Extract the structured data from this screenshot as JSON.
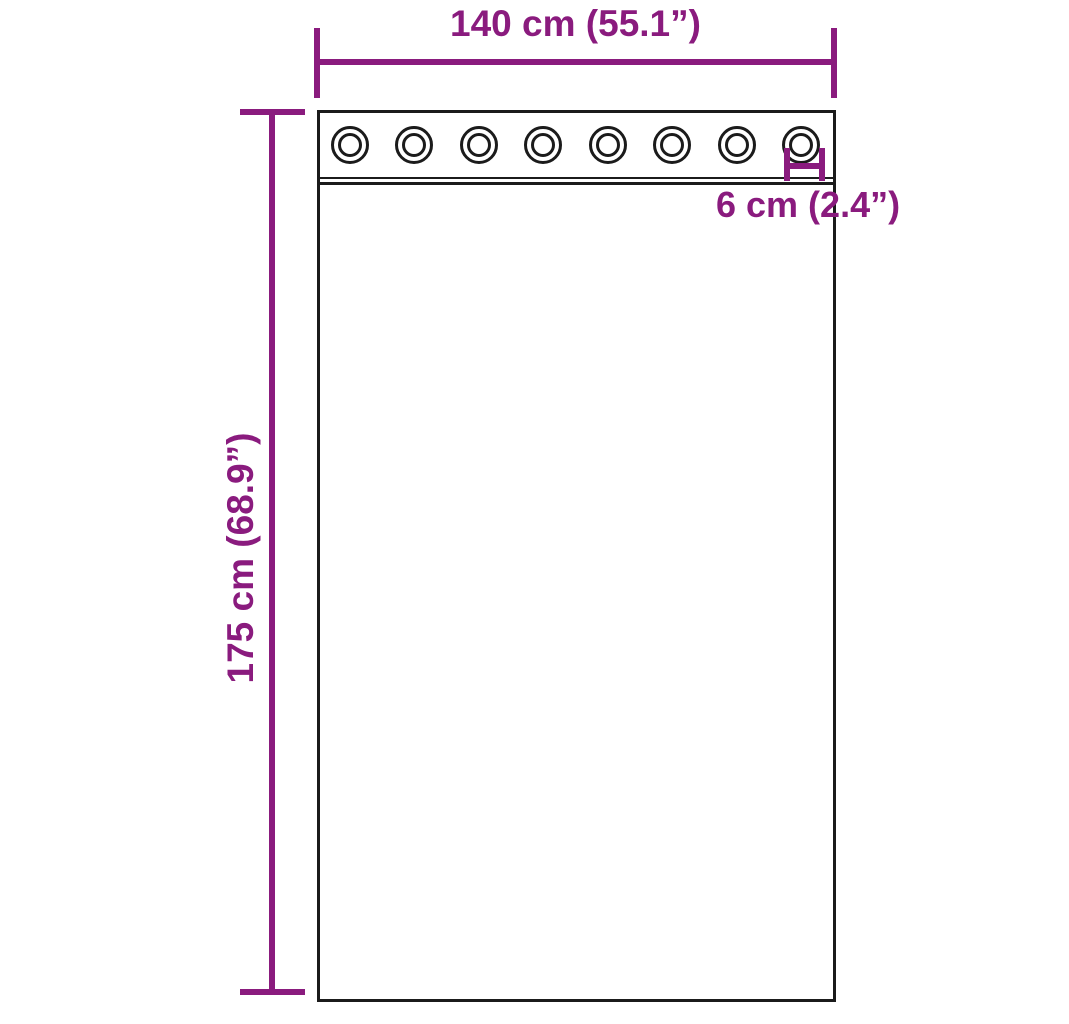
{
  "diagram": {
    "type": "product-dimension-diagram",
    "subject": "curtain panel with grommets",
    "background_color": "#ffffff",
    "accent_color": "#8a1b7e",
    "line_color": "#1b1b1b",
    "width_dimension": {
      "label": "140 cm (55.1”)",
      "value_cm": 140,
      "value_in": 55.1
    },
    "height_dimension": {
      "label": "175 cm (68.9”)",
      "value_cm": 175,
      "value_in": 68.9
    },
    "grommet_dimension": {
      "label": "6 cm (2.4”)",
      "value_cm": 6,
      "value_in": 2.4
    },
    "grommet_count": 8
  }
}
